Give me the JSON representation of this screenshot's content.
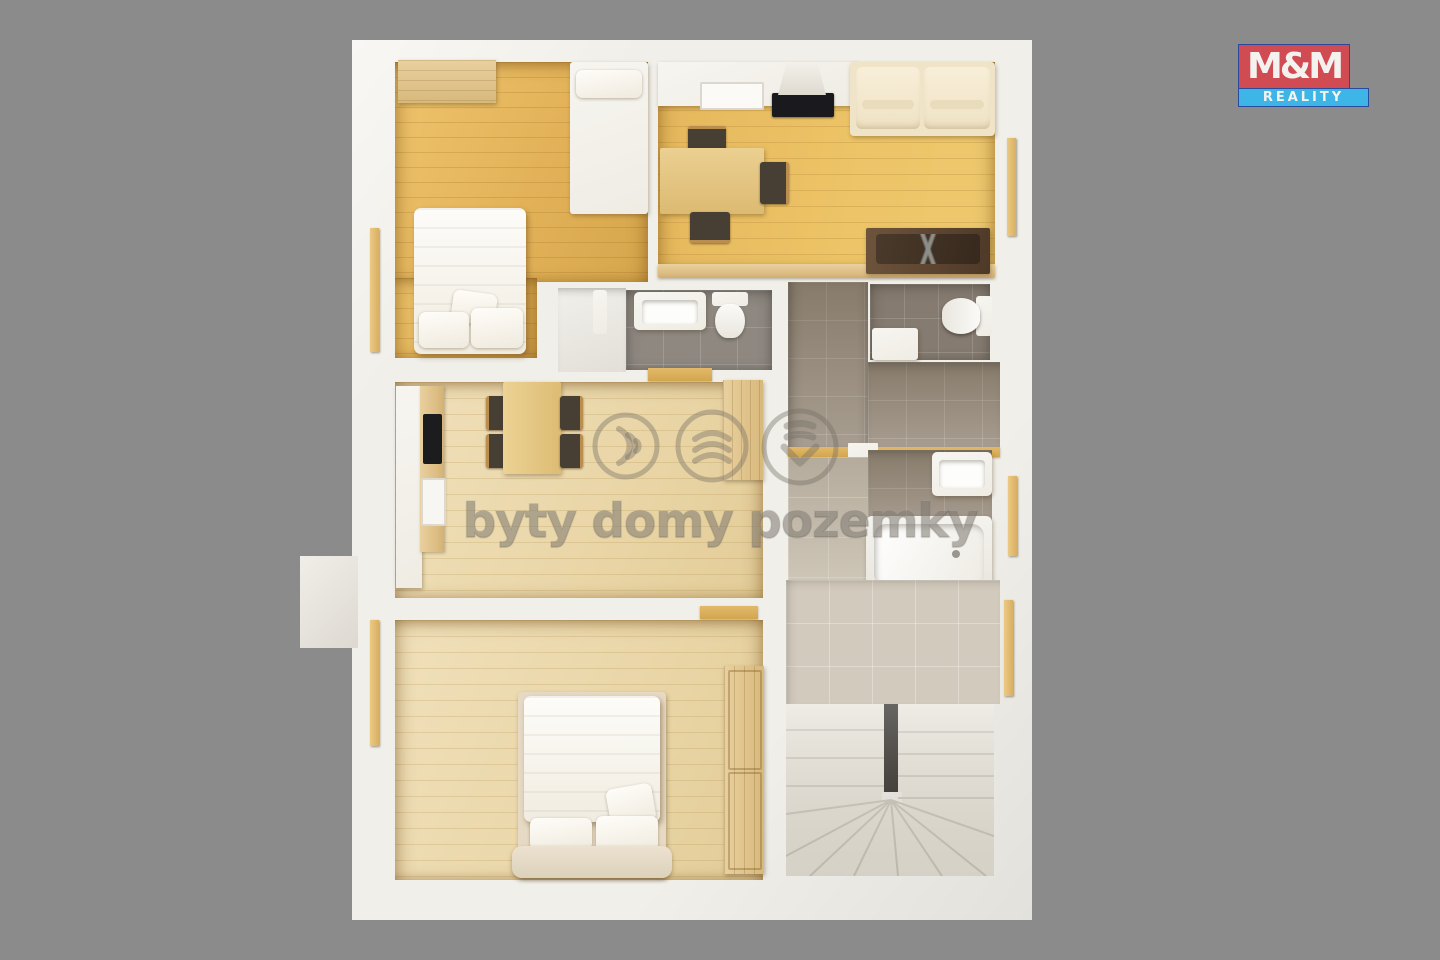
{
  "page": {
    "background_color": "#8b8b8b"
  },
  "logo": {
    "title": "M&M",
    "subtitle": "REALITY",
    "colors": {
      "title_bg": "#d04b52",
      "subtitle_bg": "#3db5e6",
      "text": "#f4f2ef",
      "border": "#2a4a9b"
    }
  },
  "watermark": {
    "text": "byty domy pozemky",
    "color": "#736d64",
    "icons": [
      {
        "name": "signal-waves-icon"
      },
      {
        "name": "roof-layers-icon"
      },
      {
        "name": "layers-chevron-icon"
      }
    ]
  },
  "floorplan": {
    "colors": {
      "wall": "#f1efe9",
      "golden_wood_floor": "#e5b75f",
      "light_wood_floor": "#ead7aa",
      "gray_tile_floor": "#8e8881",
      "dark_tile_floor": "#857b70",
      "taupe_tile_floor": "#a3988a",
      "beige_tile_floor": "#d2cabc",
      "pine_furniture": "#dfc08a",
      "stair_void": "#17140f"
    },
    "rooms": [
      {
        "name": "bedroom-upper-left",
        "furniture": [
          "double-bed",
          "single-bed",
          "wall-shelf"
        ]
      },
      {
        "name": "living-room-with-kitchen",
        "furniture": [
          "kitchen-counter",
          "sink",
          "cooktop",
          "hood",
          "sofa",
          "dining-table",
          "chairs",
          "coffee-table"
        ]
      },
      {
        "name": "shower-room",
        "furniture": [
          "vanity-sink",
          "toilet",
          "towel"
        ]
      },
      {
        "name": "wc",
        "furniture": [
          "toilet",
          "hand-sink"
        ]
      },
      {
        "name": "kitchen-dining-room",
        "furniture": [
          "kitchen-counter",
          "cooktop",
          "sink",
          "dining-table",
          "chairs",
          "wardrobe"
        ]
      },
      {
        "name": "bathroom",
        "furniture": [
          "washbasin",
          "bathtub"
        ]
      },
      {
        "name": "bedroom-lower-left",
        "furniture": [
          "double-bed",
          "bench",
          "wardrobe"
        ]
      },
      {
        "name": "hallway",
        "furniture": []
      },
      {
        "name": "staircase",
        "furniture": [
          "winder-stairs",
          "stair-void"
        ]
      }
    ]
  }
}
